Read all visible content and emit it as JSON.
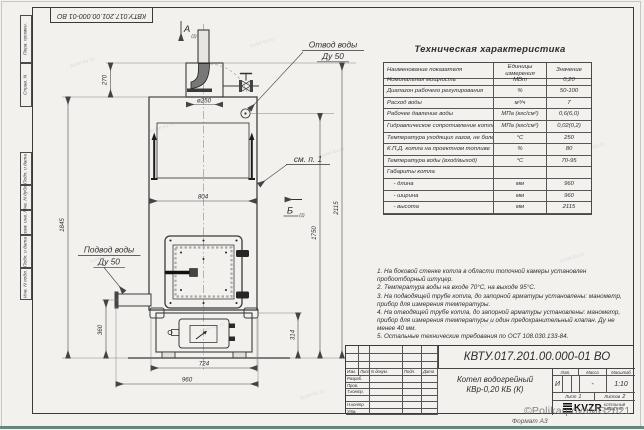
{
  "sheet": {
    "top_stamp": "КВТУ.017.201.00.000-01 ВО",
    "format_label": "Формат А3",
    "watermark": "©PolikarpovaMG2021",
    "noise": "kotel-kv.ru",
    "margin_labels": [
      "Перв. примен.",
      "Справ. N",
      "Подп. и дата",
      "Инв. N дубл.",
      "Взам. инв. N",
      "Подп. и дата",
      "Инв. N подл."
    ]
  },
  "drawing": {
    "view_a": "А",
    "view_b": "Б",
    "view_sub": "(2)",
    "outlet_label_1": "Отвод воды",
    "outlet_label_2": "Ду 50",
    "inlet_label_1": "Подвод воды",
    "inlet_label_2": "Ду 50",
    "see_note": "см. п. 1",
    "dims": {
      "d270": "270",
      "d250": "ø250",
      "d804": "804",
      "d1845": "1845",
      "d360": "360",
      "d724": "724",
      "d960": "960",
      "d314": "314",
      "d1750": "1750",
      "d2115": "2115"
    }
  },
  "spec_table": {
    "title": "Техническая характеристика",
    "headers": [
      "Наименование показателя",
      "Единицы измерения",
      "Значение"
    ],
    "rows": [
      {
        "name": "Номинальная мощность",
        "unit": "МВт",
        "value": "0,20"
      },
      {
        "name": "Диапазон рабочего регулирования",
        "unit": "%",
        "value": "50-100"
      },
      {
        "name": "Расход воды",
        "unit": "м³/ч",
        "value": "7"
      },
      {
        "name": "Рабочее давление воды",
        "unit": "МПа (кгс/см²)",
        "value": "0,6(6,0)"
      },
      {
        "name": "Гидравлическое сопротивление котла",
        "unit": "МПа (кгс/см²)",
        "value": "0,02(0,2)"
      },
      {
        "name": "Температура уходящих газов, не более",
        "unit": "°С",
        "value": "250"
      },
      {
        "name": "К.П.Д. котла на проектном топливе",
        "unit": "%",
        "value": "80"
      },
      {
        "name": "Температура воды (вход/выход)",
        "unit": "°С",
        "value": "70-95"
      },
      {
        "name": "Габариты котла",
        "unit": "",
        "value": ""
      },
      {
        "name": "    - длина",
        "unit": "мм",
        "value": "960"
      },
      {
        "name": "    - ширина",
        "unit": "мм",
        "value": "960"
      },
      {
        "name": "    - высота",
        "unit": "мм",
        "value": "2115"
      }
    ]
  },
  "notes": [
    "1. На боковой стенке котла в области топочной камеры установлен пробоотборный штуцер.",
    "2. Температура воды на входе 70°С, на выходе 95°С.",
    "3. На подводящей трубе котла, до запорной арматуры установлены: манометр, прибор для измерения температуры.",
    "4. На отводящей трубе котла, до запорной арматуры установлены: манометр, прибор для измерения температуры и один предохранительный клапан. Ду не менее 40 мм.",
    "5. Остальные технические требования по ОСТ 108.030.133-84."
  ],
  "title_block": {
    "doc_number": "КВТУ.017.201.00.000-01 ВО",
    "name_line1": "Котел водогрейный",
    "name_line2": "КВр-0,20 КБ (К)",
    "rev_headers": [
      "Изм.",
      "Лист",
      "N докум.",
      "Подп.",
      "Дата"
    ],
    "sig_rows": [
      "Разраб.",
      "Пров.",
      "Т.контр.",
      "",
      "Н.контр.",
      "Утв."
    ],
    "lit_h": "Лит.",
    "mass_h": "Масса",
    "scale_h": "Масштаб",
    "lit": "И",
    "mass": "-",
    "scale": "1:10",
    "sheet_h": "Лист",
    "sheet_n": "1",
    "sheets_h": "Листов",
    "sheets_n": "2",
    "logo": "KVZR",
    "logo_s1": "КОТЕЛЬНЫЙ",
    "logo_s2": "ЗАВОД РЭП"
  }
}
